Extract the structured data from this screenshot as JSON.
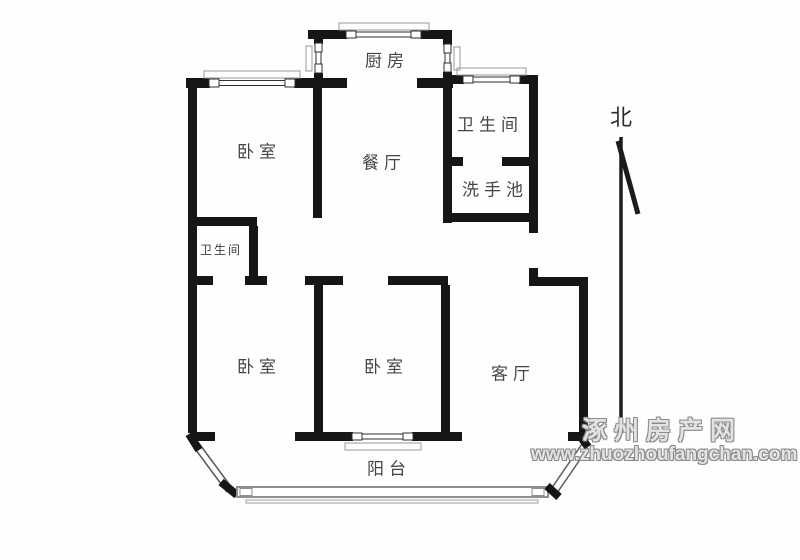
{
  "rooms": [
    {
      "id": "kitchen",
      "label": "厨房"
    },
    {
      "id": "bedroom-top-left",
      "label": "卧室"
    },
    {
      "id": "dining-room",
      "label": "餐厅"
    },
    {
      "id": "bathroom",
      "label": "卫生间"
    },
    {
      "id": "washbasin",
      "label": "洗手池"
    },
    {
      "id": "bathroom-small",
      "label": "卫生间"
    },
    {
      "id": "bedroom-bottom-left",
      "label": "卧室"
    },
    {
      "id": "bedroom-bottom-middle",
      "label": "卧室"
    },
    {
      "id": "living-room",
      "label": "客厅"
    },
    {
      "id": "balcony",
      "label": "阳台"
    }
  ],
  "compass": {
    "label": "北"
  },
  "watermark": {
    "site_name": "涿州房产网",
    "site_url": "www.zhuozhoufangchan.com"
  },
  "colors": {
    "wall": "#161616",
    "window_frame": "#2f2f2f",
    "window_sill": "#9a9a9a",
    "balcony_window": "#8f8f8f",
    "label": "#454545",
    "watermark_outline": "#8a8a8a",
    "background": "#fefefe"
  }
}
